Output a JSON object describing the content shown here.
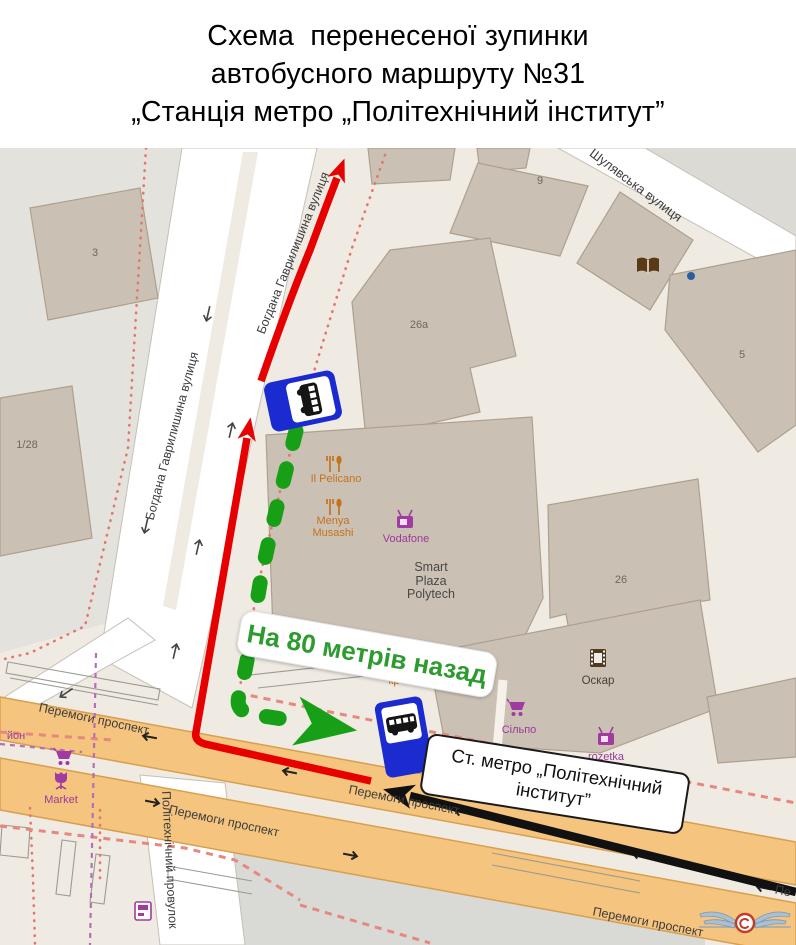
{
  "title": {
    "line1": "Схема  перенесеної зупинки",
    "line2": "автобусного маршруту №31",
    "line3": "„Станція метро „Політехнічний інститут”"
  },
  "map": {
    "streets": {
      "bohdana": "Богдана Гаврилишина вулиця",
      "shuliavska": "Шулявська вулиця",
      "peremohy": "Перемоги проспект",
      "peremohy_short": "Пе",
      "provulok": "Політехнічний провулок"
    },
    "buildings": {
      "b3": "3",
      "b128": "1/28",
      "b26a": "26а",
      "b9": "9",
      "b5": "5",
      "b26": "26"
    },
    "pois": {
      "il_pelicano": "Il Pelicano",
      "menya": "Menya Musashi",
      "vodafone": "Vodafone",
      "smart_plaza": "Smart Plaza Polytech",
      "oskar": "Оскар",
      "silpo": "Сільпо",
      "rozetka": "rozetka",
      "market": "Market",
      "yon": "йон",
      "kry": "кри",
      "kr": "кр"
    },
    "callouts": {
      "green_note": "На 80 метрів назад",
      "metro_line1": "Ст. метро „Політехнічний",
      "metro_line2": "інститут”"
    },
    "colors": {
      "route_red": "#e60000",
      "route_green": "#17A017",
      "metro_arrow_black": "#111111",
      "bus_sign_blue": "#1B2BD0",
      "road_orange": "#F5C47E",
      "note_green_text": "#2E9B2E"
    }
  }
}
